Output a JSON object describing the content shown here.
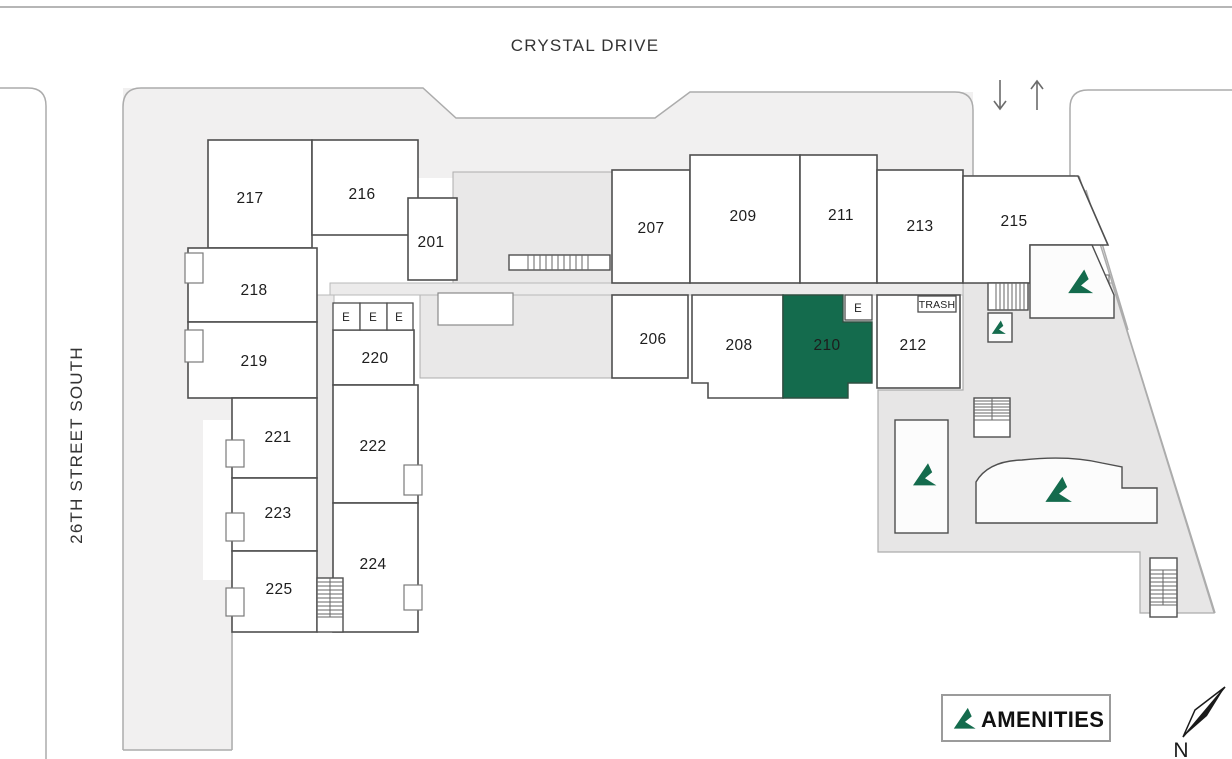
{
  "streets": {
    "top": "CRYSTAL DRIVE",
    "left": "26TH STREET SOUTH"
  },
  "units": [
    {
      "label": "217"
    },
    {
      "label": "216"
    },
    {
      "label": "201"
    },
    {
      "label": "207"
    },
    {
      "label": "209"
    },
    {
      "label": "211"
    },
    {
      "label": "213"
    },
    {
      "label": "215"
    },
    {
      "label": "218"
    },
    {
      "label": "219"
    },
    {
      "label": "220"
    },
    {
      "label": "206"
    },
    {
      "label": "208"
    },
    {
      "label": "210",
      "highlighted": true
    },
    {
      "label": "212"
    },
    {
      "label": "221"
    },
    {
      "label": "222"
    },
    {
      "label": "223"
    },
    {
      "label": "224"
    },
    {
      "label": "225"
    }
  ],
  "selected_unit": "210",
  "markers": {
    "elevator": "E",
    "trash": "TRASH"
  },
  "legend": {
    "label": "AMENITIES",
    "icon": "amenity-triangle"
  },
  "compass": {
    "label": "N"
  },
  "icons": {
    "amenity": "green-triangle-logo",
    "compass": "north-needle",
    "driveway_in": "down-arrow",
    "driveway_out": "up-arrow"
  },
  "colors": {
    "highlight": "#146B4D",
    "amenity_icon": "#146B4D",
    "sidewalk": "#F1F0F0",
    "courtyard": "#E9E8E8"
  }
}
